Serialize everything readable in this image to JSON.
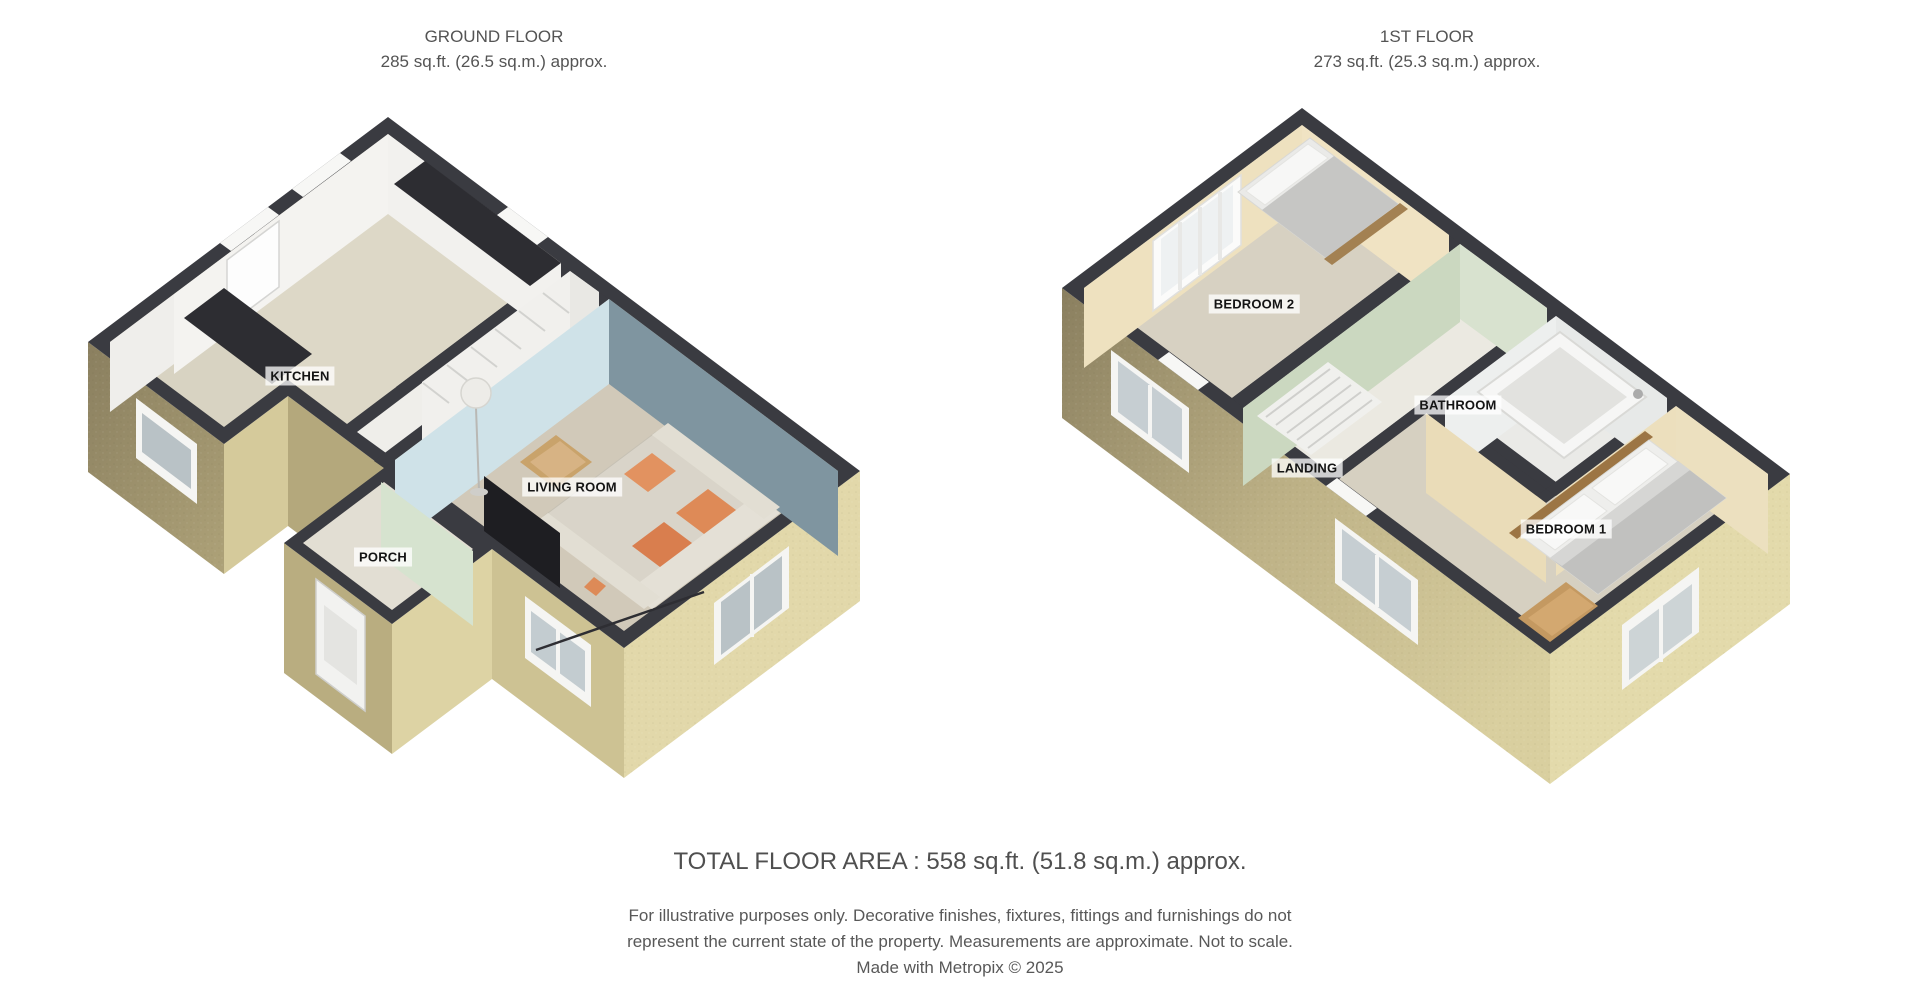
{
  "floors": [
    {
      "id": "ground",
      "title": "GROUND FLOOR",
      "area": "285 sq.ft. (26.5 sq.m.) approx.",
      "rooms": [
        {
          "name": "kitchen",
          "label": "KITCHEN"
        },
        {
          "name": "living-room",
          "label": "LIVING ROOM"
        },
        {
          "name": "porch",
          "label": "PORCH"
        }
      ]
    },
    {
      "id": "first",
      "title": "1ST FLOOR",
      "area": "273 sq.ft. (25.3 sq.m.) approx.",
      "rooms": [
        {
          "name": "bedroom-2",
          "label": "BEDROOM 2"
        },
        {
          "name": "bathroom",
          "label": "BATHROOM"
        },
        {
          "name": "landing",
          "label": "LANDING"
        },
        {
          "name": "bedroom-1",
          "label": "BEDROOM 1"
        }
      ]
    }
  ],
  "footer": {
    "total_area": "TOTAL FLOOR AREA : 558 sq.ft. (51.8 sq.m.) approx.",
    "disclaimer_lines": [
      "For illustrative purposes only. Decorative finishes, fixtures, fittings and furnishings do not",
      "represent the current state of the property. Measurements are approximate. Not to scale.",
      "Made with Metropix © 2025"
    ]
  },
  "palette": {
    "wall_top_dark": "#3a3b41",
    "exterior_sand_light": "#e3daab",
    "exterior_sand": "#cdc293",
    "exterior_khaki_dark": "#8a7f5f",
    "living_accent_slate": "#7f95a0",
    "living_accent_pale_blue": "#cfe2e8",
    "porch_landing_sage": "#cbd8c0",
    "bedroom_cream": "#eee1bf",
    "carpet_beige": "#d2caba",
    "cushion_orange": "#de8a57",
    "furniture_wood": "#a98a5c"
  }
}
